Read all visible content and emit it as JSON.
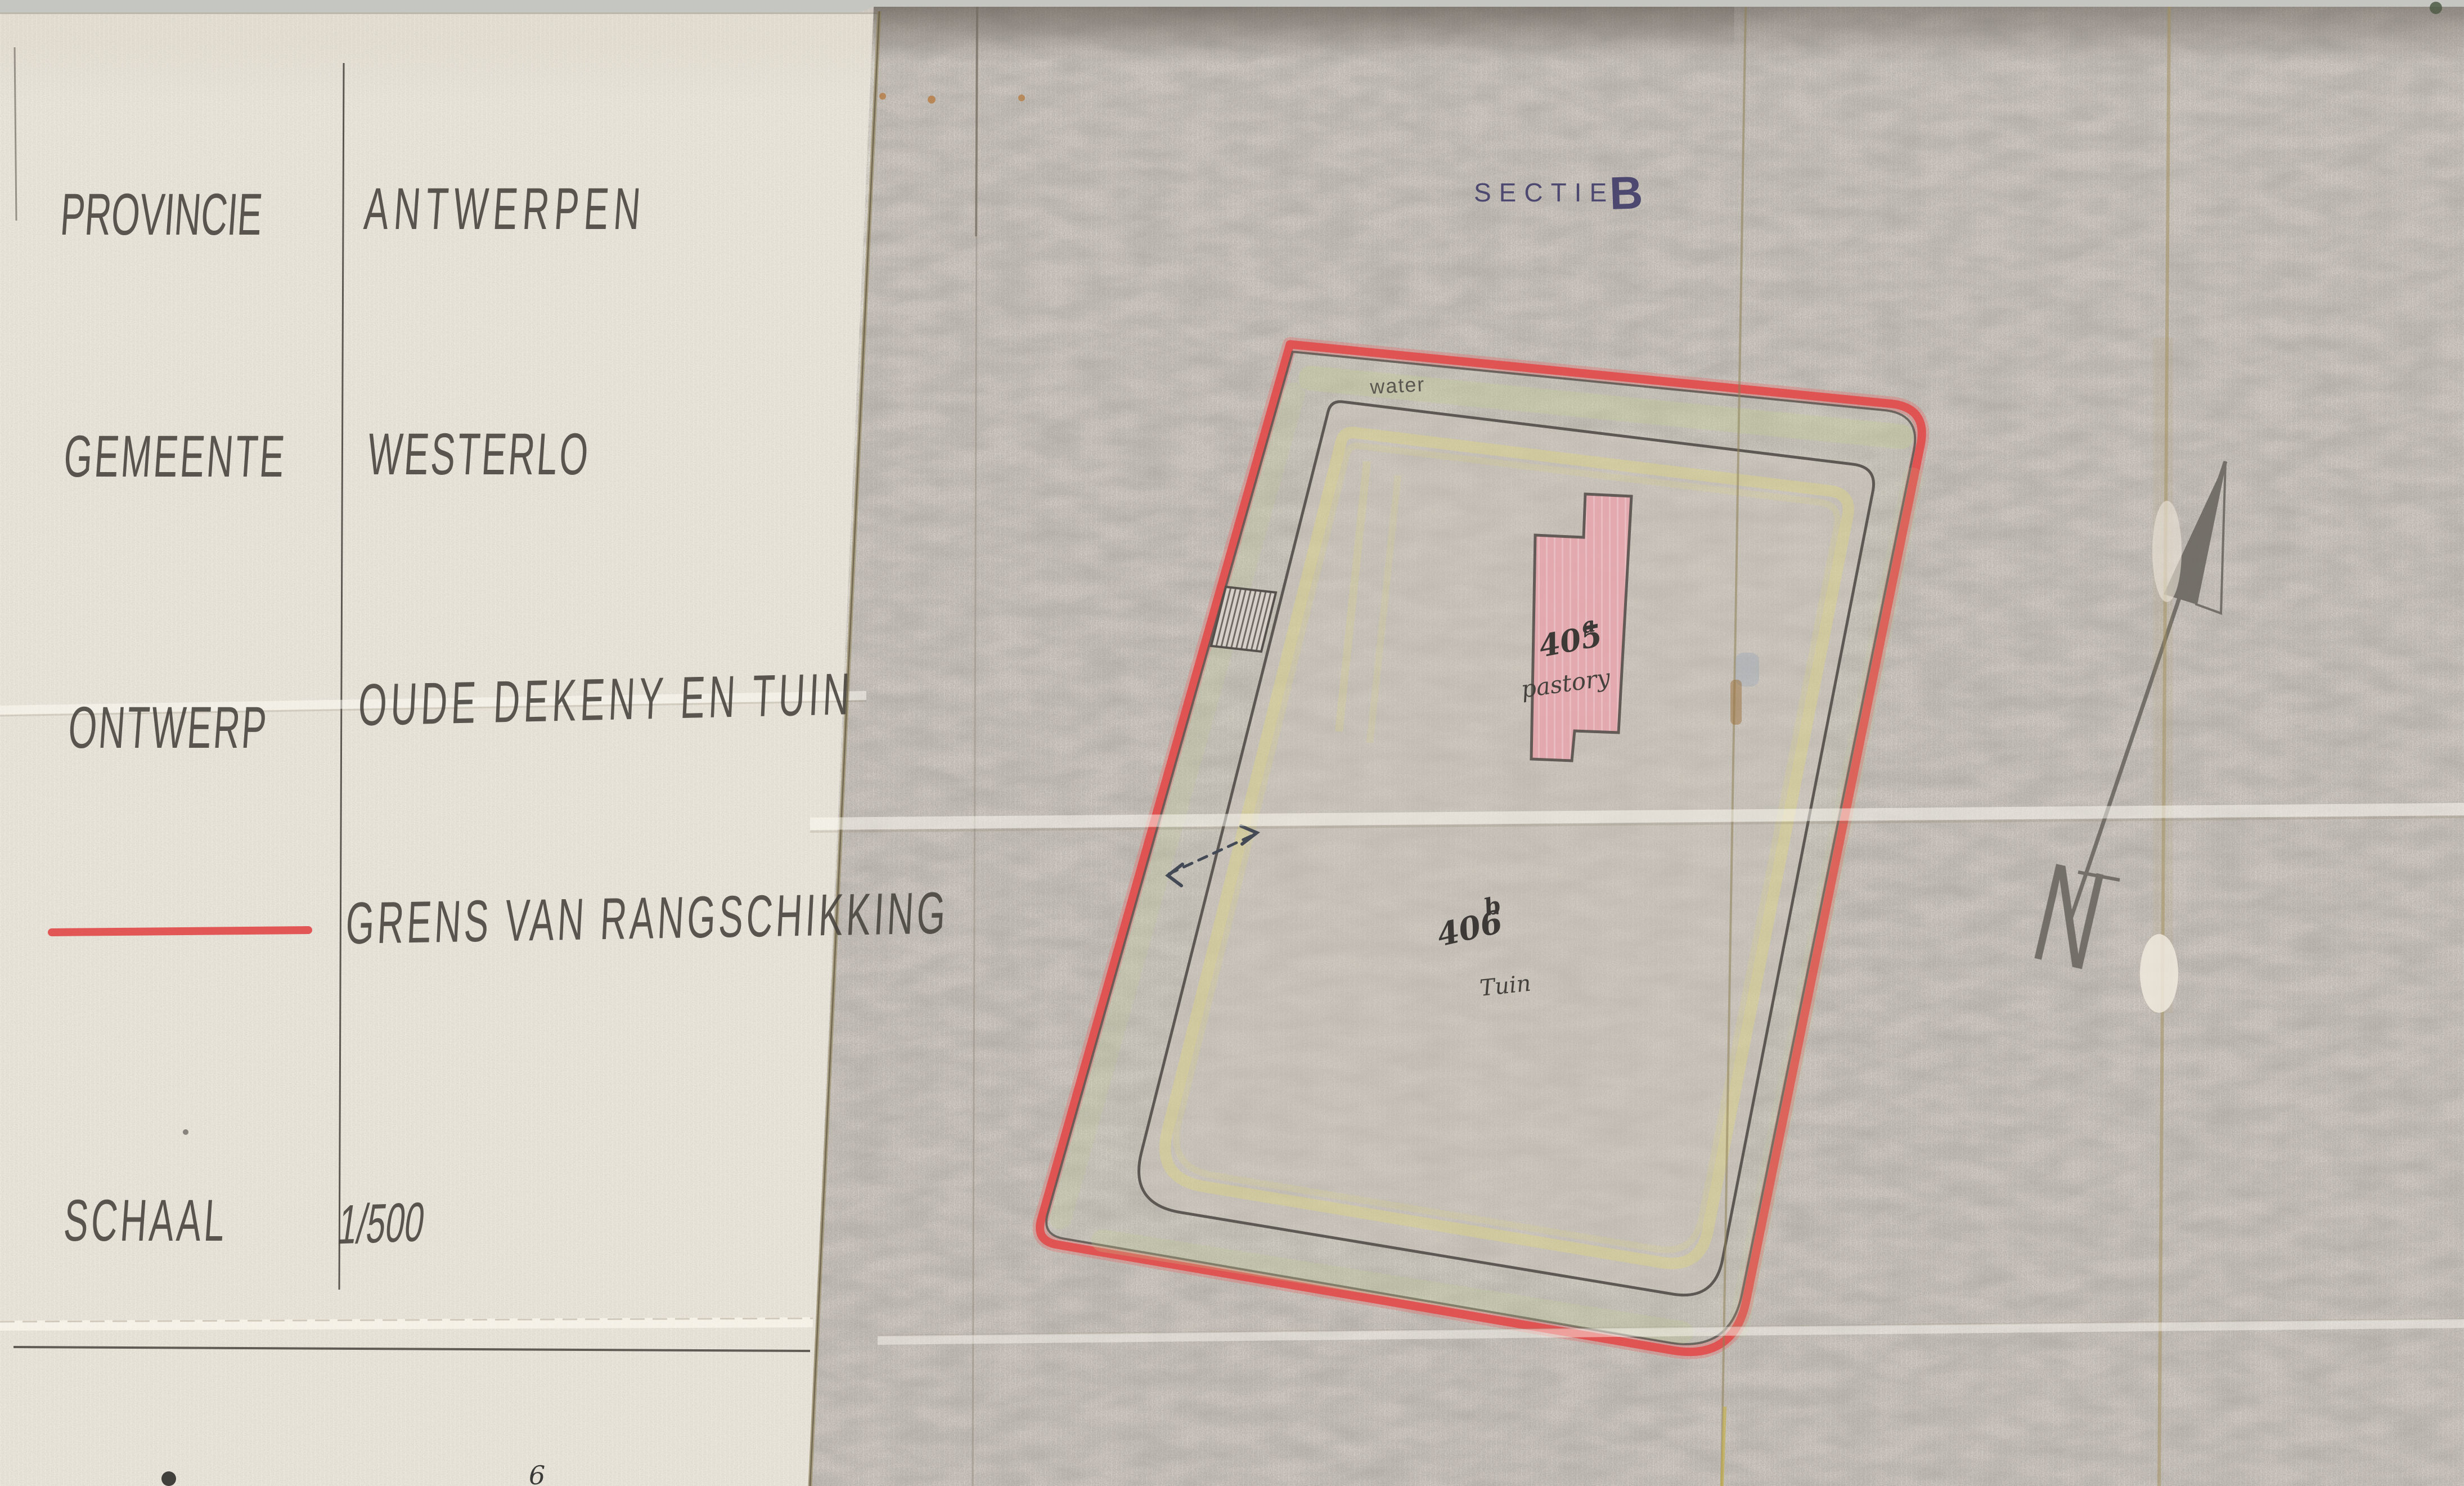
{
  "scan": {
    "background_color": "#c5c5c1",
    "title_sheet_color": "#e9e4d9",
    "map_sheet_color": "#cdc7bf",
    "stray_mark": "6"
  },
  "title_block": {
    "rows": [
      {
        "label": "PROVINCIE",
        "value": "ANTWERPEN"
      },
      {
        "label": "GEMEENTE",
        "value": "WESTERLO"
      },
      {
        "label": "ONTWERP",
        "value": "OUDE DEKENY EN TUIN"
      },
      {
        "label": "",
        "value": "GRENS VAN RANGSCHIKKING"
      },
      {
        "label": "SCHAAL",
        "value": "1/500"
      }
    ],
    "legend_line_color": "#e14b4b"
  },
  "map": {
    "section_label": "SECTIE",
    "section_value": "B",
    "water_label": "water",
    "parcel_pastorij": {
      "number": "405",
      "suffix": "a",
      "name": "pastory"
    },
    "parcel_tuin": {
      "number": "406",
      "suffix": "b",
      "name": "Tuin"
    },
    "compass_letter": "N",
    "colors": {
      "boundary_red": "#e14b4b",
      "building_pink": "#e8a3ab",
      "building_outline": "#55504b",
      "ink_gray": "#55504b",
      "section_ink": "#4c4870",
      "yellow_path": "#e3d878",
      "water_strip_green": "#c2cf92"
    }
  }
}
